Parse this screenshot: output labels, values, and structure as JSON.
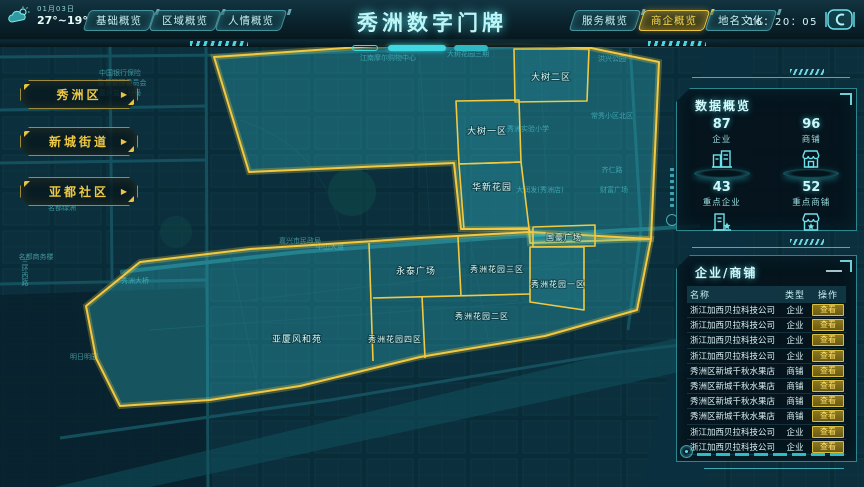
{
  "header": {
    "title": "秀洲数字门牌",
    "date": "01月03日",
    "temperature": "27°~19°",
    "time": "16：20：05",
    "tabs_left": [
      {
        "label": "基础概览",
        "active": false
      },
      {
        "label": "区域概览",
        "active": false
      },
      {
        "label": "人情概览",
        "active": false
      }
    ],
    "tabs_right": [
      {
        "label": "服务概览",
        "active": false
      },
      {
        "label": "商企概览",
        "active": true
      },
      {
        "label": "地名文化",
        "active": false
      }
    ]
  },
  "sidebar": {
    "buttons": [
      {
        "label": "秀洲区"
      },
      {
        "label": "新城街道"
      },
      {
        "label": "亚都社区"
      }
    ]
  },
  "map": {
    "regions": [
      {
        "name": "大树二区"
      },
      {
        "name": "大树一区"
      },
      {
        "name": "华新花园"
      },
      {
        "name": "国豪广场"
      },
      {
        "name": "永泰广场"
      },
      {
        "name": "秀洲花园三区"
      },
      {
        "name": "秀洲花园一区"
      },
      {
        "name": "秀洲花园二区"
      },
      {
        "name": "秀洲花园四区"
      },
      {
        "name": "亚厦风和苑"
      }
    ],
    "background_labels": [
      {
        "text": "江南摩尔购物中心"
      },
      {
        "text": "大树花园三期"
      },
      {
        "text": "洪兴公园"
      },
      {
        "text": "常秀小区北区"
      },
      {
        "text": "秀洲实验小学"
      },
      {
        "text": "大润发(秀洲店)"
      },
      {
        "text": "财富广场"
      },
      {
        "text": "齐仁路"
      },
      {
        "text": "中山大道"
      },
      {
        "text": "嘉兴市民政局"
      },
      {
        "text": "秀洲大桥"
      },
      {
        "text": "名都商务楼"
      },
      {
        "text": "名都绿洲"
      },
      {
        "text": "三环西路"
      },
      {
        "text": "中国银行保险"
      },
      {
        "text": "监督管理委员会"
      },
      {
        "text": "嘉兴监管分局"
      },
      {
        "text": "明日明园"
      }
    ]
  },
  "data_overview": {
    "title": "数据概览",
    "stats": [
      {
        "value": "87",
        "label": "企业",
        "icon": "building-icon"
      },
      {
        "value": "96",
        "label": "商铺",
        "icon": "store-icon"
      },
      {
        "value": "43",
        "label": "重点企业",
        "icon": "building-star-icon"
      },
      {
        "value": "52",
        "label": "重点商铺",
        "icon": "store-star-icon"
      }
    ]
  },
  "list_panel": {
    "title": "企业/商铺",
    "columns": [
      "名称",
      "类型",
      "操作"
    ],
    "action_label": "查看",
    "rows": [
      {
        "name": "浙江加西贝拉科技公司",
        "type": "企业"
      },
      {
        "name": "浙江加西贝拉科技公司",
        "type": "企业"
      },
      {
        "name": "浙江加西贝拉科技公司",
        "type": "企业"
      },
      {
        "name": "浙江加西贝拉科技公司",
        "type": "企业"
      },
      {
        "name": "秀洲区新城千秋水果店",
        "type": "商铺"
      },
      {
        "name": "秀洲区新城千秋水果店",
        "type": "商铺"
      },
      {
        "name": "秀洲区新城千秋水果店",
        "type": "商铺"
      },
      {
        "name": "秀洲区新城千秋水果店",
        "type": "商铺"
      },
      {
        "name": "浙江加西贝拉科技公司",
        "type": "企业"
      },
      {
        "name": "浙江加西贝拉科技公司",
        "type": "企业"
      }
    ]
  },
  "colors": {
    "accent_cyan": "#3FDDE6",
    "accent_yellow": "#F0C43E",
    "highlight_fill": "#38C7D4",
    "title_text": "#BEF4F6",
    "button_gold": "#E9C53F"
  }
}
